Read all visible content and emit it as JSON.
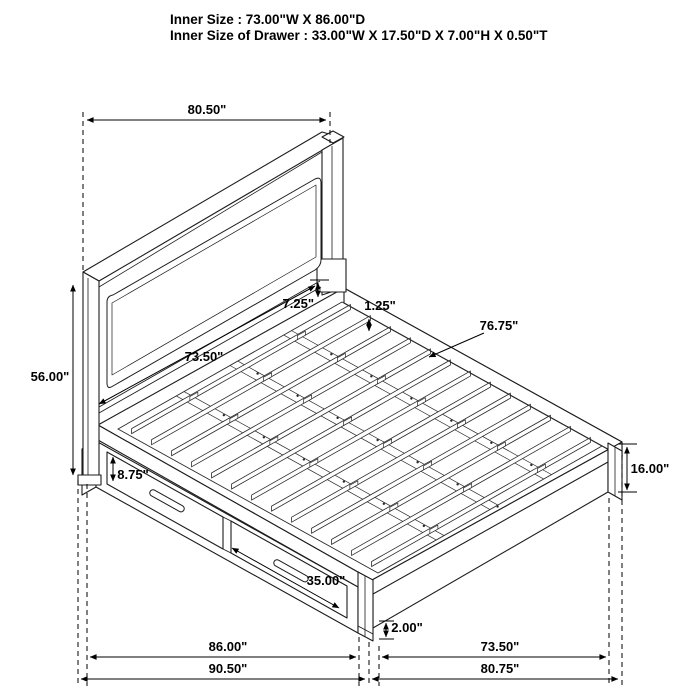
{
  "header": {
    "line1": "Inner Size : 73.00\"W X 86.00\"D",
    "line2": "Inner Size of Drawer : 33.00\"W X 17.50\"D X 7.00\"H X 0.50\"T"
  },
  "labels": {
    "headboard_width": "80.50\"",
    "headboard_height": "56.00\"",
    "headboard_to_deck": "7.25\"",
    "slat_thickness": "1.25\"",
    "side_rail_length": "76.75\"",
    "headboard_inner_width": "73.50\"",
    "drawer_face_height": "8.75\"",
    "drawer_width": "35.00\"",
    "footboard_height": "16.00\"",
    "floor_clearance": "2.00\"",
    "base_side_length": "86.00\"",
    "overall_depth": "90.50\"",
    "footboard_inner_width": "73.50\"",
    "overall_width": "80.75\""
  },
  "colors": {
    "drawing_line": "#1c1c1c",
    "dimension_line": "#000000",
    "background": "#ffffff"
  }
}
